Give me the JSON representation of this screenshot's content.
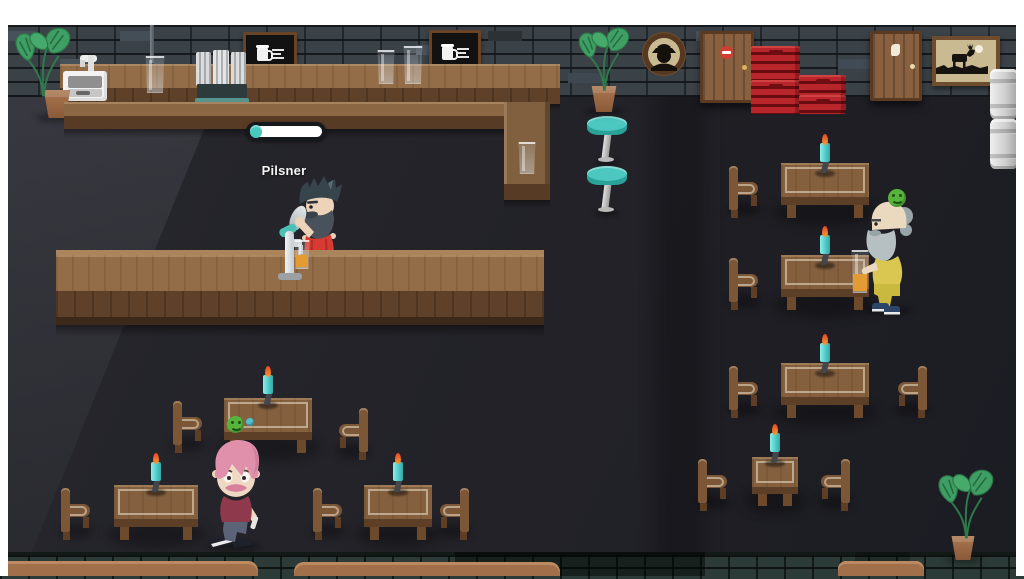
{
  "hud": {
    "brew_item_label": "Pilsner",
    "progress_percent": 16,
    "progress_bar": {
      "case_color": "#15181d",
      "track_color": "#ffffff",
      "fill_color": "#49c8be"
    }
  },
  "characters": {
    "bartender": {
      "role": "bartender",
      "action": "pouring-beer",
      "shirt_color": "#d73a30"
    },
    "seated_customer": {
      "mood": "happy",
      "mood_color": "#58b33c",
      "drink": "beer",
      "outfit_color": "#d9c751"
    },
    "walking_customer": {
      "hair_color": "#e190ab",
      "shirt_color": "#8e3a4c"
    }
  },
  "scene": {
    "wall_signs": {
      "menu_boards": 2,
      "icon": "beer-mug-icon"
    },
    "wall_art": {
      "round_frame": "detective-silhouette",
      "rect_frame": "moose-silhouette"
    },
    "furniture": {
      "tables": 7,
      "chairs": 11,
      "bar_stools": 2
    },
    "props": {
      "beer_crates": 4,
      "kegs": 2,
      "plants": 3,
      "candles": 7,
      "table_mood_icon": "happy-smiley",
      "table_coin": "teal-ball"
    },
    "doors": {
      "count": 2,
      "left_door_sign": "no-entry-sign",
      "right_door_sign": "restroom-sign"
    }
  },
  "palette": {
    "letterbox": "#ffffff",
    "floor": "#232329",
    "brick_wall": "#3a4248",
    "wood_light": "#936d48",
    "wood_dark": "#5f412a",
    "accent_teal": "#49c5bc",
    "candle_cyan": "#57d8d4",
    "crate_red": "#b8262b",
    "beer_amber": "#e39b33",
    "mood_green": "#58b33c"
  }
}
